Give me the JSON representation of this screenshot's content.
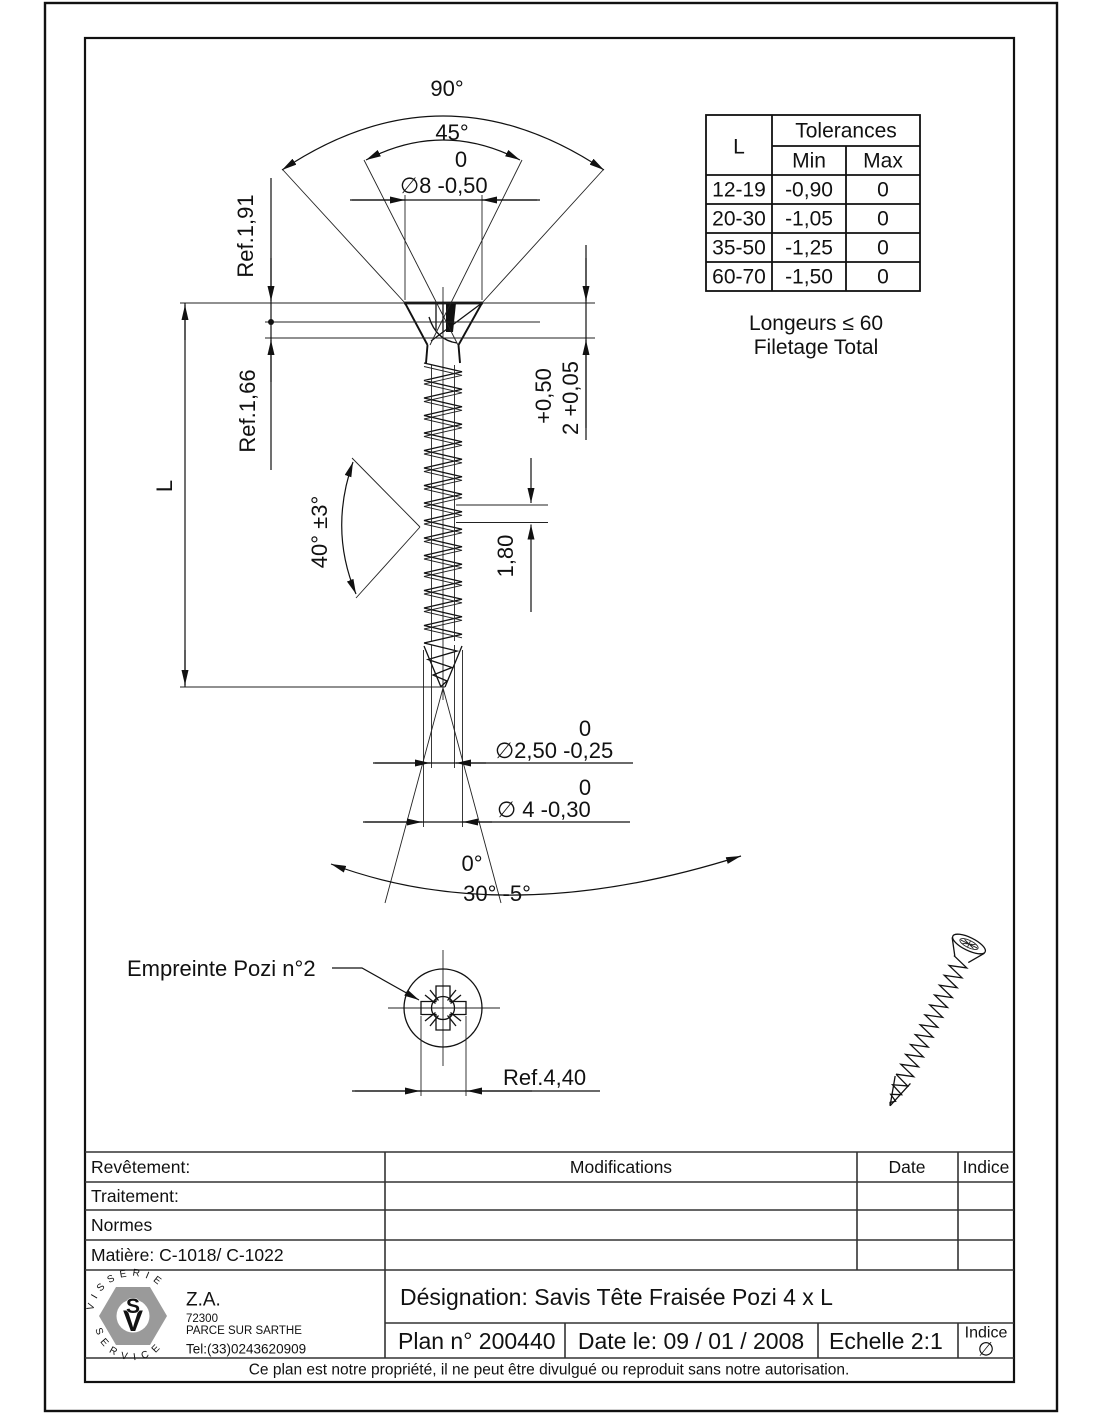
{
  "tolerances_table": {
    "col_l": "L",
    "header": "Tolerances",
    "min": "Min",
    "max": "Max",
    "rows": [
      [
        "12-19",
        "-0,90",
        "0"
      ],
      [
        "20-30",
        "-1,05",
        "0"
      ],
      [
        "35-50",
        "-1,25",
        "0"
      ],
      [
        "60-70",
        "-1,50",
        "0"
      ]
    ]
  },
  "notes": {
    "longeurs": "Longeurs ≤ 60",
    "filetage": "Filetage Total"
  },
  "dimensions": {
    "angle_outer": "90°",
    "angle_inner": "45°",
    "head_dia_upper": "0",
    "head_dia": "∅8 -0,50",
    "ref_head": "Ref.1,91",
    "ref_neck": "Ref.1,66",
    "length": "L",
    "thread_angle": "40° ±3°",
    "head_h_upper": "+0,50",
    "head_h": "2 +0,05",
    "pitch": "1,80",
    "core_dia_upper": "0",
    "core_dia": "∅2,50 -0,25",
    "outer_dia_upper": "0",
    "outer_dia": "∅ 4 -0,30",
    "tip_angle_upper": "0°",
    "tip_angle": "30° -5°",
    "recess_label": "Empreinte Pozi n°2",
    "recess_width": "Ref.4,40"
  },
  "title_block": {
    "revetement": "Revêtement:",
    "traitement": "Traitement:",
    "normes": "Normes",
    "matiere": "Matière: C-1018/ C-1022",
    "modifications": "Modifications",
    "date": "Date",
    "indice": "Indice",
    "designation": "Désignation: Savis Tête Fraisée Pozi  4 x L",
    "plan": "Plan n° 200440",
    "date_le": "Date le: 09 / 01 / 2008",
    "echelle": "Echelle 2:1",
    "indice_label": "Indice",
    "indice_value": "∅",
    "notice": "Ce plan est notre propriété, il ne peut être divulgué ou reproduit sans notre autorisation."
  },
  "logo": {
    "arc_top": "VISSERIE",
    "arc_bottom": "SERVICE",
    "monogram_v": "V",
    "monogram_s": "S",
    "company_za": "Z.A.",
    "zip": "72300",
    "city": "PARCE SUR SARTHE",
    "tel": "Tel:(33)0243620909"
  }
}
